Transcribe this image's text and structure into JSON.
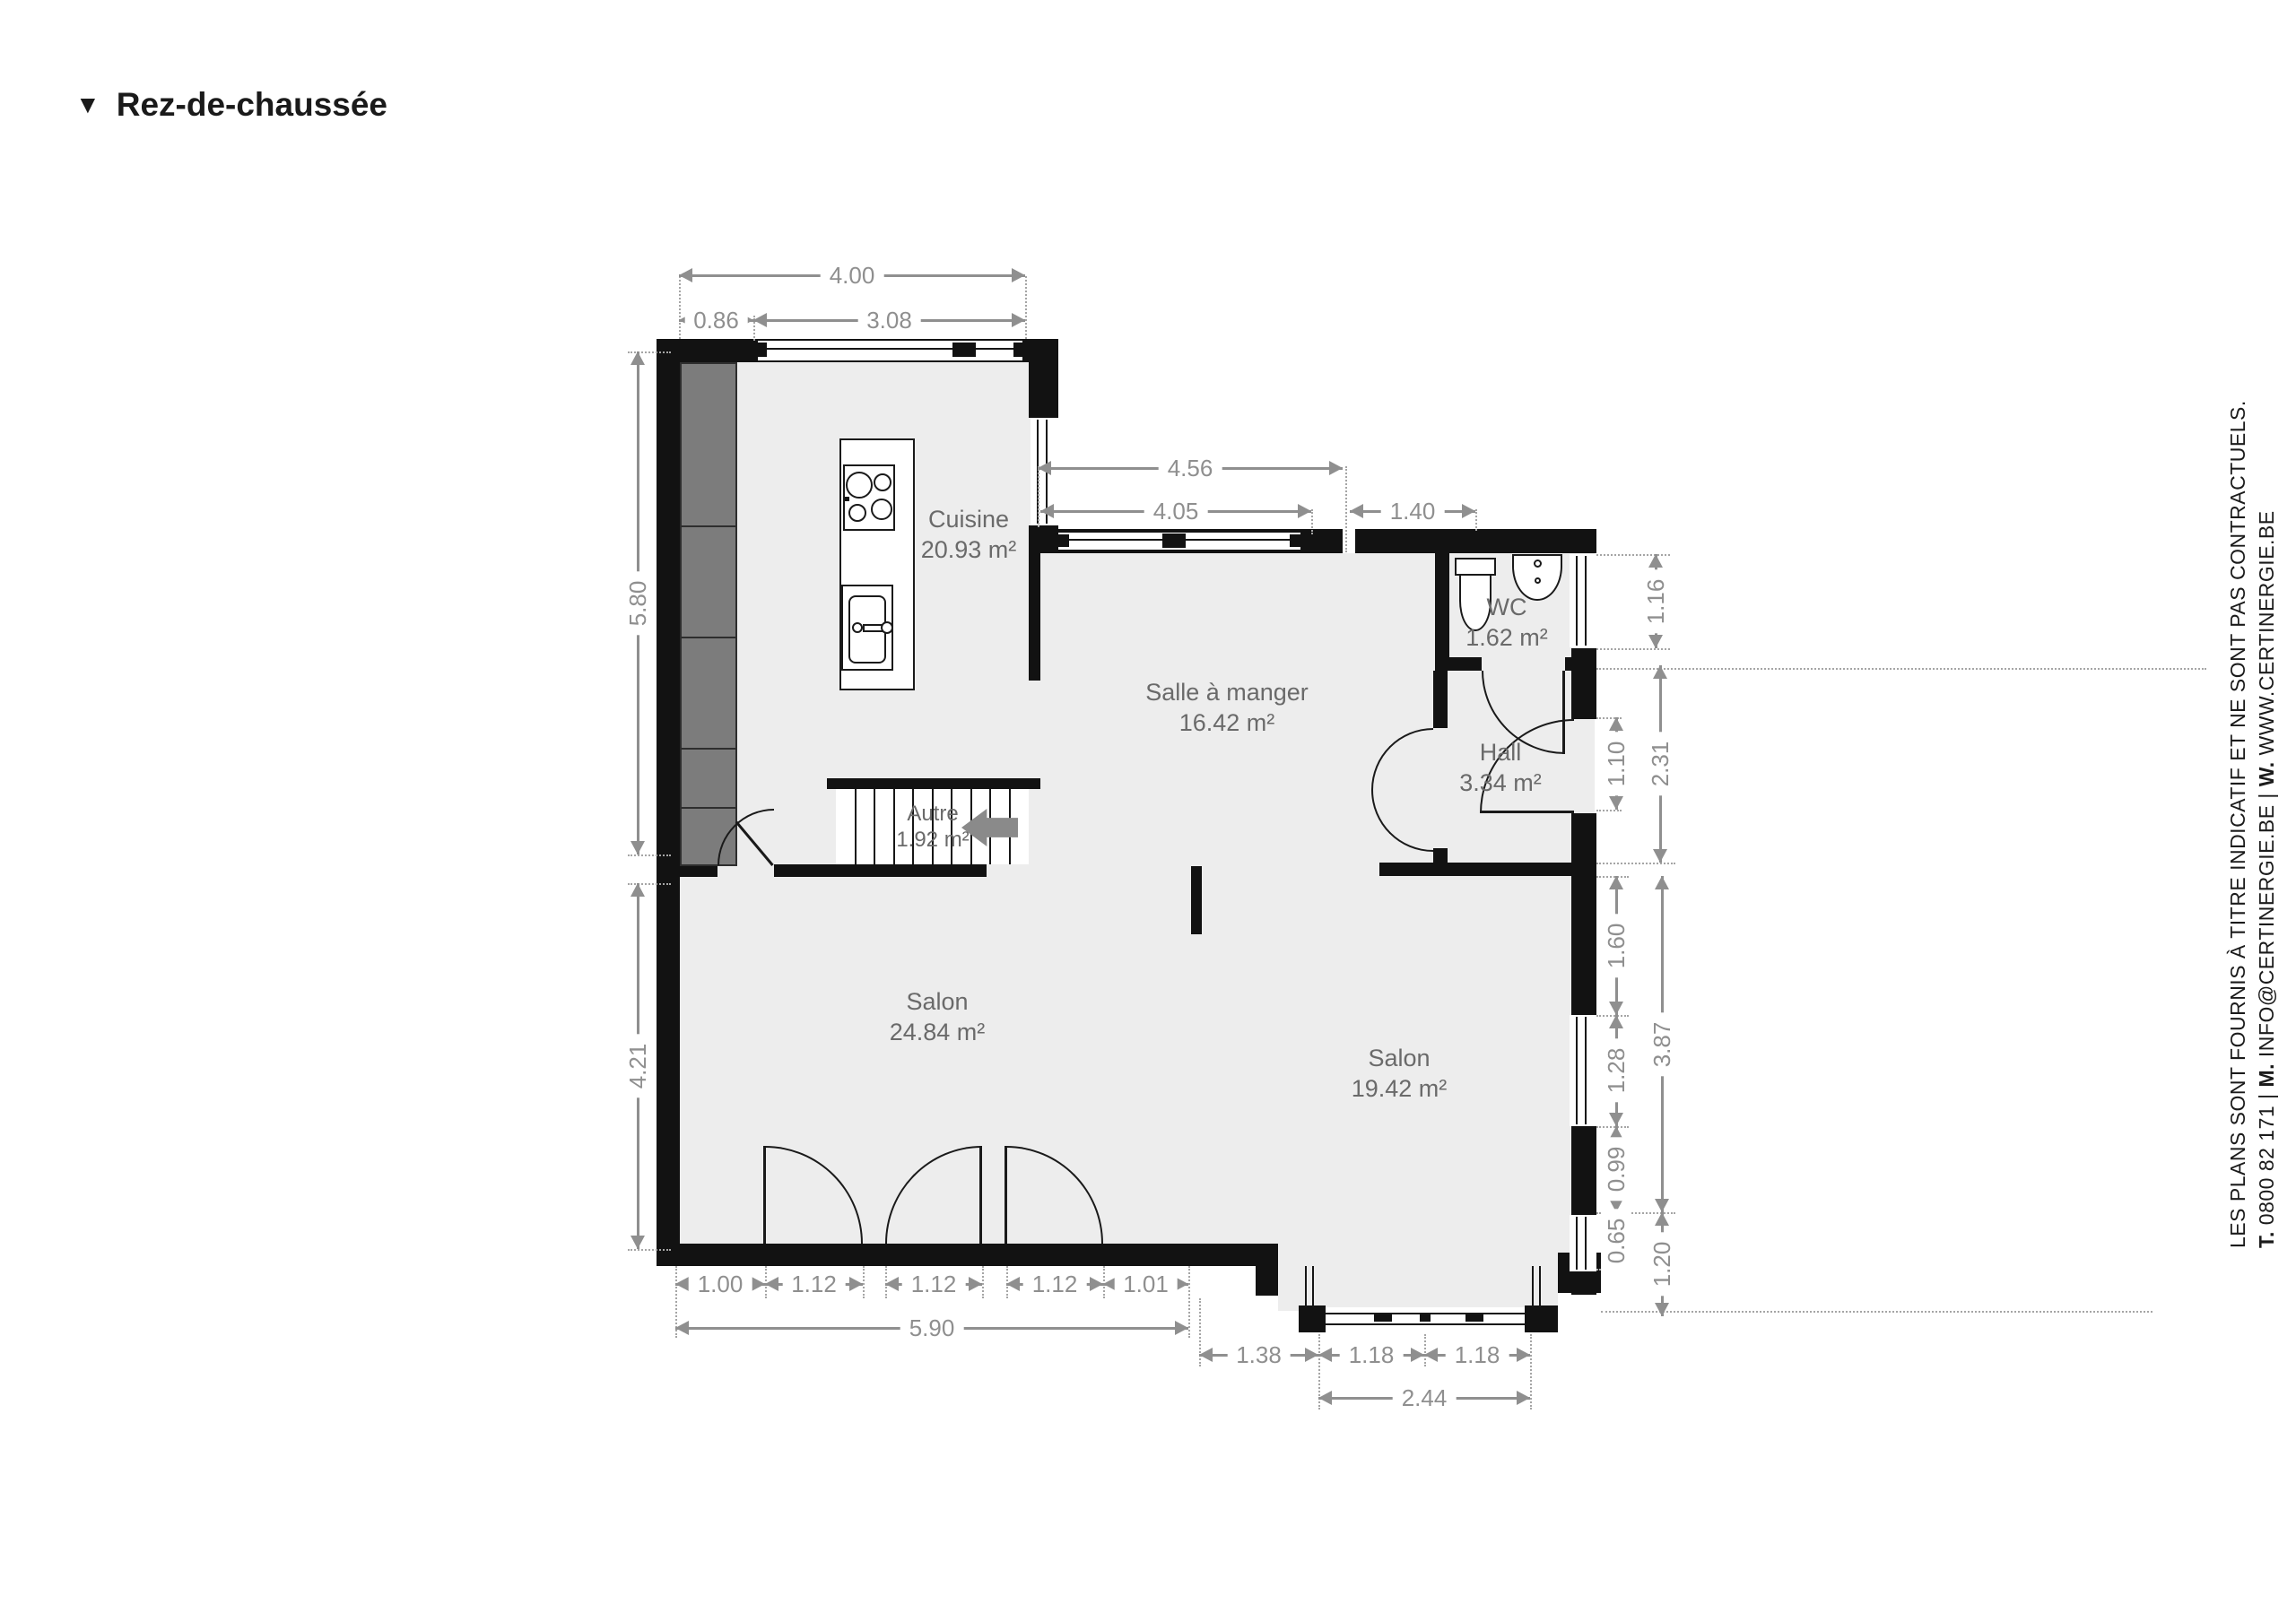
{
  "title": {
    "marker": "▼",
    "text": "Rez-de-chaussée"
  },
  "rooms": [
    {
      "name": "Cuisine",
      "area": "20.93 m²"
    },
    {
      "name": "Salle à manger",
      "area": "16.42 m²"
    },
    {
      "name": "WC",
      "area": "1.62 m²"
    },
    {
      "name": "Hall",
      "area": "3.34 m²"
    },
    {
      "name": "Autre",
      "area": "1.92 m²"
    },
    {
      "name": "Salon",
      "area": "24.84 m²"
    },
    {
      "name": "Salon",
      "area": "19.42 m²"
    }
  ],
  "dimensions": {
    "top": [
      "4.00",
      "0.86",
      "3.08",
      "4.56",
      "4.05",
      "1.40"
    ],
    "left": [
      "5.80",
      "4.21"
    ],
    "right": [
      "1.16",
      "1.10",
      "2.31",
      "1.60",
      "1.28",
      "3.87",
      "0.99",
      "0.65",
      "1.20"
    ],
    "bottom": [
      "1.00",
      "1.12",
      "1.12",
      "1.12",
      "1.01",
      "5.90",
      "1.38",
      "1.18",
      "1.18",
      "2.44"
    ]
  },
  "sidebar": {
    "line1": "LES PLANS SONT FOURNIS À TITRE INDICATIF ET NE SONT PAS CONTRACTUELS.",
    "line2": [
      {
        "t": "T.",
        "b": true
      },
      {
        "t": " 0800 82 171 | "
      },
      {
        "t": "M.",
        "b": true
      },
      {
        "t": " INFO@CERTINERGIE.BE | "
      },
      {
        "t": "W.",
        "b": true
      },
      {
        "t": " WWW.CERTINERGIE.BE"
      }
    ]
  },
  "colors": {
    "wall": "#121212",
    "room_fill": "#ededed",
    "cabinet": "#7c7c7c",
    "dimension": "#8f8f8f",
    "room_label": "#6a6a6a"
  }
}
